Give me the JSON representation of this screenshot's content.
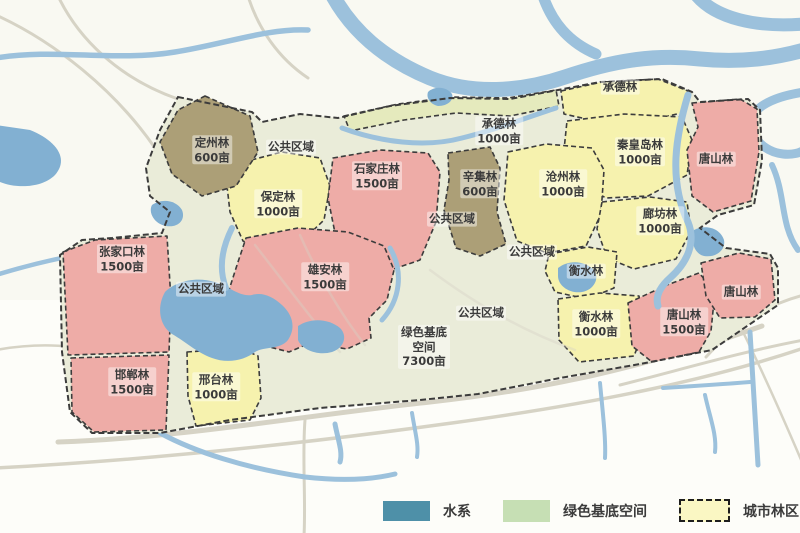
{
  "palette": {
    "water_legend": "#4e90a8",
    "water_river": "#9cc1dc",
    "water_lake": "#82b0d2",
    "green_base_legend": "#c6dfb4",
    "legend_yellow": "#faf7c3",
    "urban_forest_yellow": "#f6f2ae",
    "urban_forest_pink": "#eeaca7",
    "urban_forest_tan": "#ac9f77",
    "strip_green": "#e5eabd",
    "plan_base": "#eaecd9",
    "road": "#d6d3c5",
    "boundary": "#3c3c3c",
    "label_text": "#3b3b3b"
  },
  "regions": [
    {
      "name": "定州林",
      "area": "600亩"
    },
    {
      "name": "公共区域",
      "area": ""
    },
    {
      "name": "保定林",
      "area": "1000亩"
    },
    {
      "name": "石家庄林",
      "area": "1500亩"
    },
    {
      "name": "承德林",
      "area": "1000亩"
    },
    {
      "name": "辛集林",
      "area": "600亩"
    },
    {
      "name": "承德林",
      "area": ""
    },
    {
      "name": "沧州林",
      "area": "1000亩"
    },
    {
      "name": "秦皇岛林",
      "area": "1000亩"
    },
    {
      "name": "唐山林",
      "area": ""
    },
    {
      "name": "廊坊林",
      "area": "1000亩"
    },
    {
      "name": "公共区域",
      "area": ""
    },
    {
      "name": "公共区域",
      "area": ""
    },
    {
      "name": "衡水林",
      "area": ""
    },
    {
      "name": "张家口林",
      "area": "1500亩"
    },
    {
      "name": "公共区域",
      "area": ""
    },
    {
      "name": "雄安林",
      "area": "1500亩"
    },
    {
      "name": "公共区域",
      "area": ""
    },
    {
      "name": "绿色基底空间",
      "area": "7300亩"
    },
    {
      "name": "衡水林",
      "area": "1000亩"
    },
    {
      "name": "唐山林",
      "area": "1500亩"
    },
    {
      "name": "唐山林",
      "area": ""
    },
    {
      "name": "邯郸林",
      "area": "1500亩"
    },
    {
      "name": "邢台林",
      "area": "1000亩"
    }
  ],
  "legend": {
    "items": [
      {
        "label": "水系"
      },
      {
        "label": "绿色基底空间"
      },
      {
        "label": "城市林区"
      }
    ]
  }
}
